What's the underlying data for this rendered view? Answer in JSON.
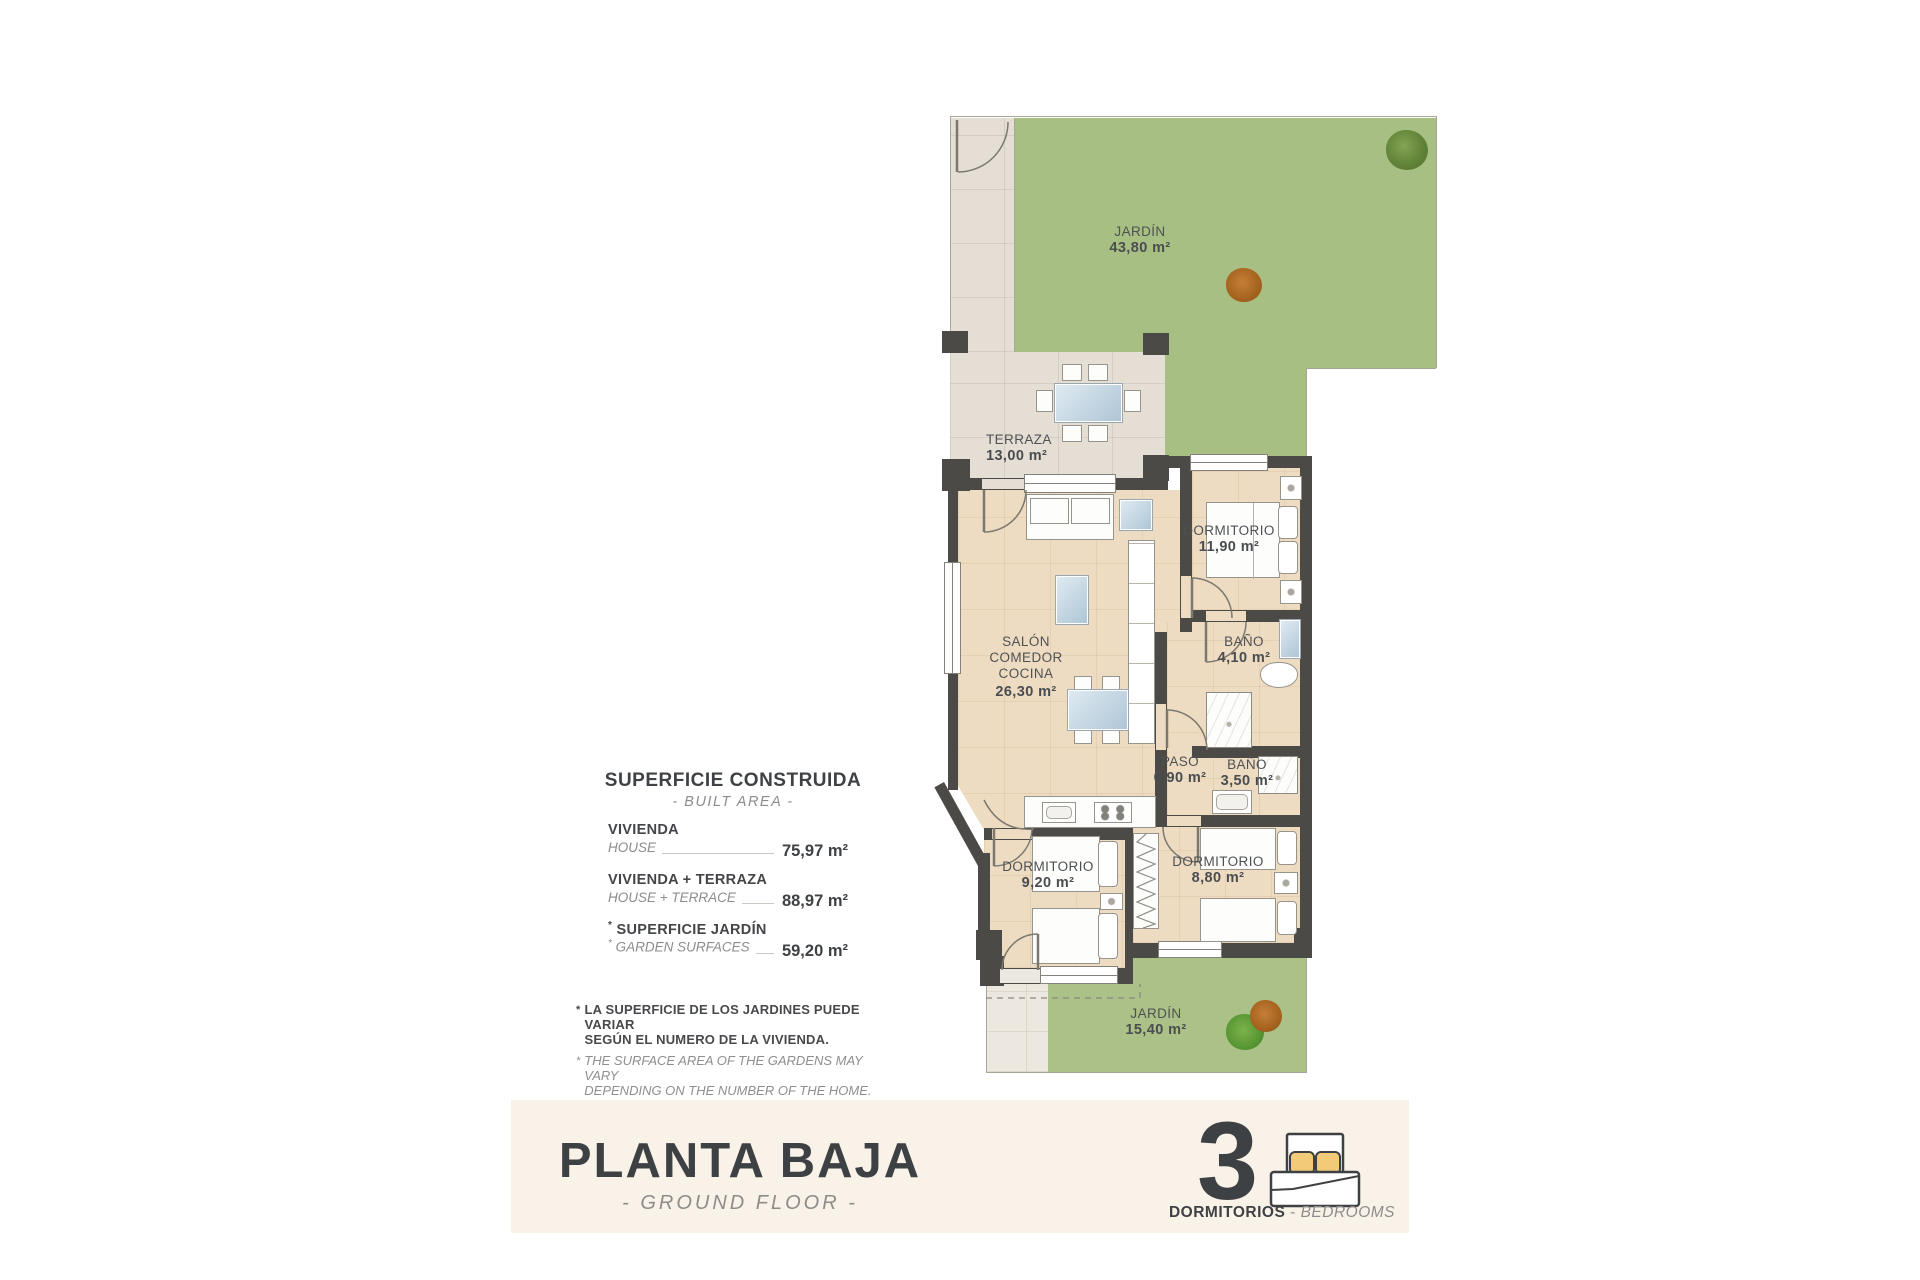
{
  "plan": {
    "garden_top": {
      "name": "JARDÍN",
      "area": "43,80 m²"
    },
    "terraza": {
      "name": "TERRAZA",
      "area": "13,00 m²"
    },
    "salon": {
      "line1": "SALÓN",
      "line2": "COMEDOR",
      "line3": "COCINA",
      "area": "26,30 m²"
    },
    "dormitorio1": {
      "name": "DORMITORIO",
      "area": "11,90 m²"
    },
    "bano1": {
      "name": "BAÑO",
      "area": "4,10 m²"
    },
    "paso": {
      "name": "PASO",
      "area": "0,90 m²"
    },
    "bano2": {
      "name": "BAÑO",
      "area": "3,50 m²"
    },
    "dormitorio2": {
      "name": "DORMITORIO",
      "area": "9,20 m²"
    },
    "dormitorio3": {
      "name": "DORMITORIO",
      "area": "8,80 m²"
    },
    "garden_bottom": {
      "name": "JARDÍN",
      "area": "15,40 m²"
    }
  },
  "summary": {
    "title": "SUPERFICIE CONSTRUIDA",
    "subtitle": "- BUILT AREA -",
    "rows": [
      {
        "mark": "",
        "label_es": "VIVIENDA",
        "label_en": "HOUSE",
        "value": "75,97 m²"
      },
      {
        "mark": "",
        "label_es": "VIVIENDA + TERRAZA",
        "label_en": "HOUSE + TERRACE",
        "value": "88,97 m²"
      },
      {
        "mark": "*",
        "label_es": "SUPERFICIE JARDÍN",
        "label_en": "GARDEN SURFACES",
        "value": "59,20 m²"
      }
    ],
    "note_mark": "*",
    "note_es_line1": "LA SUPERFICIE DE LOS JARDINES PUEDE VARIAR",
    "note_es_line2": "SEGÚN EL NUMERO DE LA VIVIENDA.",
    "note_en_line1": "THE SURFACE AREA OF THE GARDENS MAY VARY",
    "note_en_line2": "DEPENDING ON THE NUMBER OF THE HOME."
  },
  "footer": {
    "title": "PLANTA BAJA",
    "subtitle": "- GROUND FLOOR -",
    "bedrooms_count": "3",
    "bedrooms_label_es": "DORMITORIOS",
    "separator": " - ",
    "bedrooms_label_en": "BEDROOMS"
  },
  "colors": {
    "garden_green": "#a8bf83",
    "terrace_tile": "#e5ded5",
    "interior_floor": "#eedcc2",
    "wall": "#4b4a46",
    "footer_bar": "#f9f2e8",
    "pillow_yellow": "#f2ca78",
    "text_dark": "#3f4245",
    "text_gray": "#8d8c8a"
  }
}
